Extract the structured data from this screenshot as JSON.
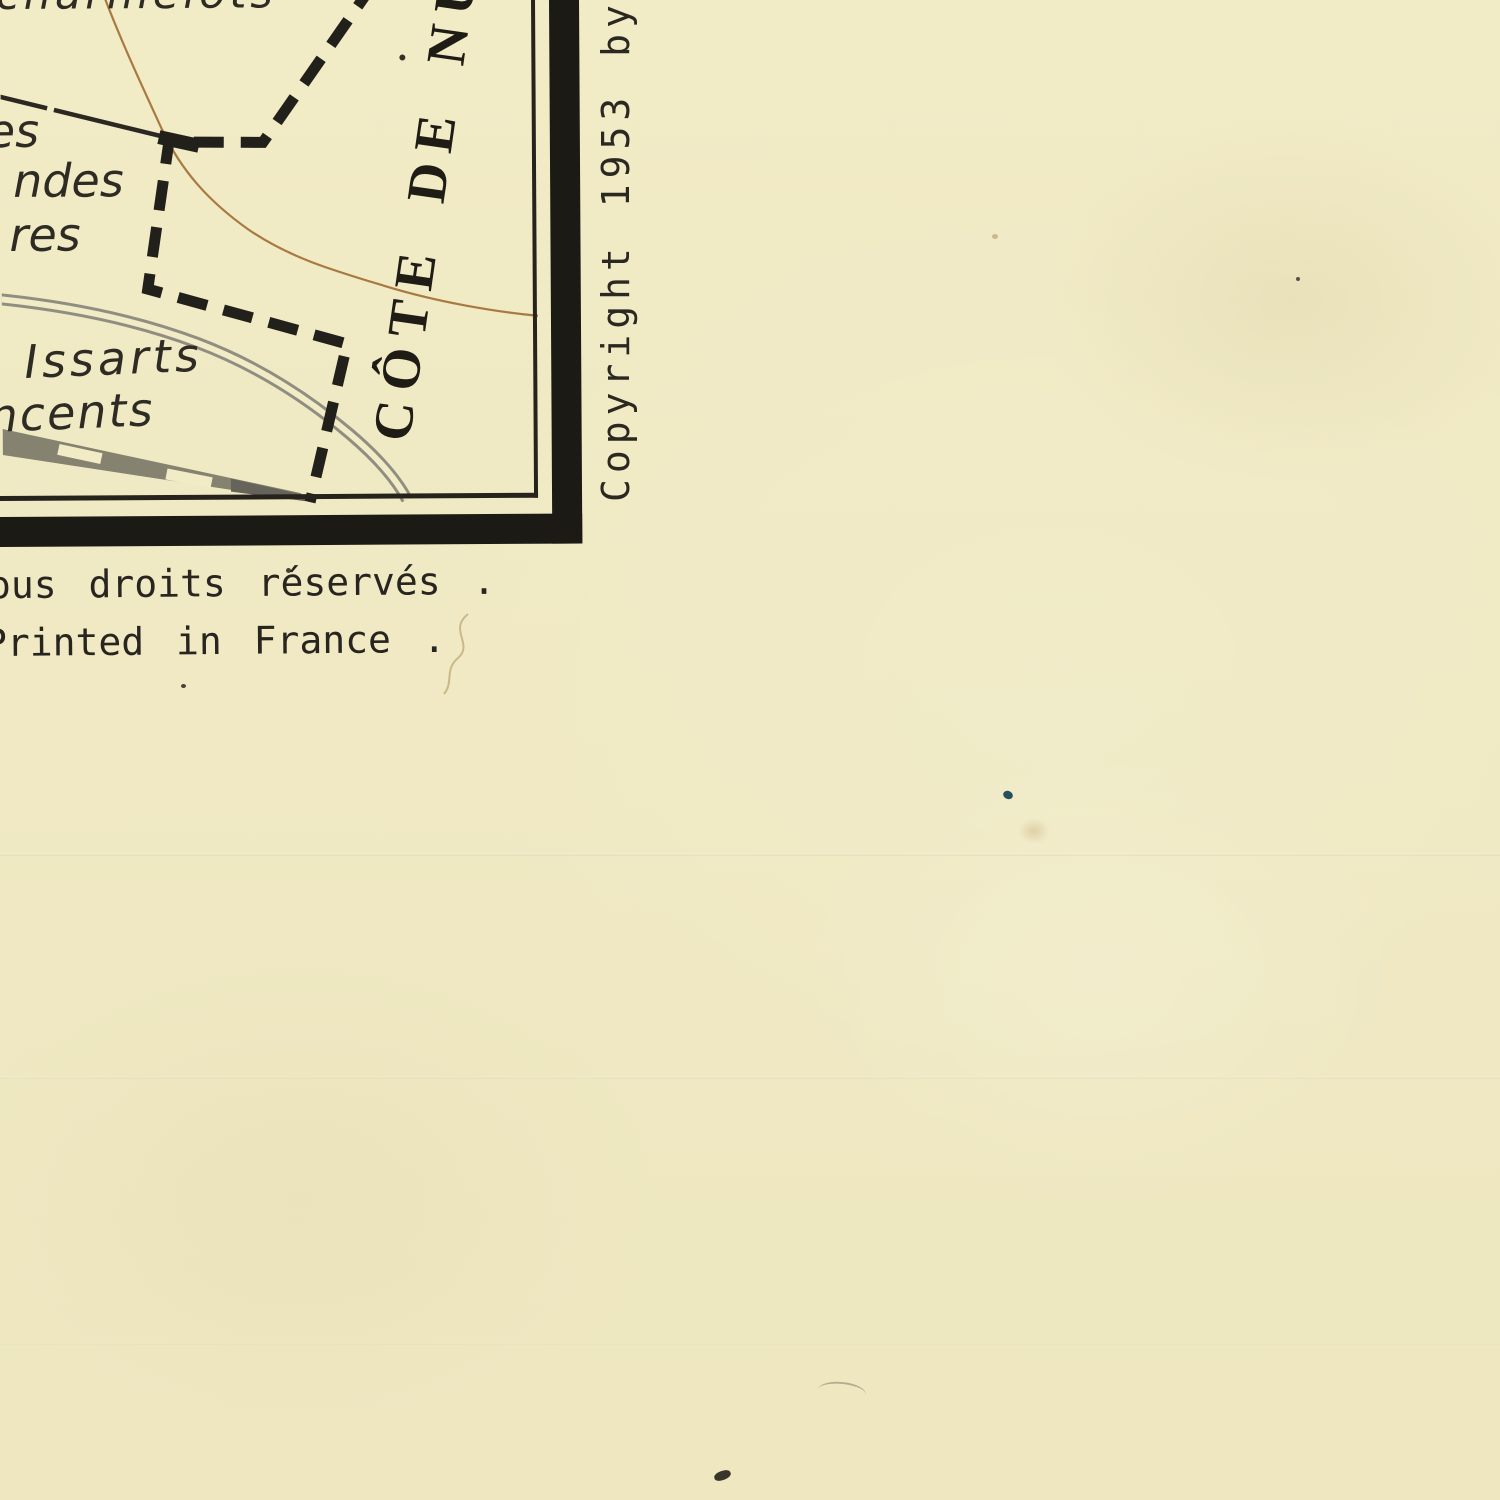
{
  "map": {
    "title_fragment": "CÔTE DE NU",
    "labels": {
      "top_fragment": "charmelots",
      "left_fragment_1": "es",
      "left_fragment_2": "ndes",
      "left_fragment_3": "res",
      "issarts": "Issarts",
      "vincents_fragment": "ncents"
    },
    "features": {
      "boundary_style": "thick black dashed line",
      "contour_line_color": "#a87a42",
      "road_color": "#908e80",
      "railway_color": "#85836f"
    }
  },
  "margin_texts": {
    "copyright_vertical": "Copyright 1953 by",
    "rights_reserved": "ous droits réservés .",
    "printed_in": "Printed in France ."
  },
  "colors": {
    "paper": "#f1ebc6",
    "ink": "#26231d",
    "frame": "#1c1a15",
    "contour_brown": "#a87a42",
    "road_gray": "#908e80",
    "railway_gray": "#85836f",
    "blue_speck": "#27505a"
  }
}
